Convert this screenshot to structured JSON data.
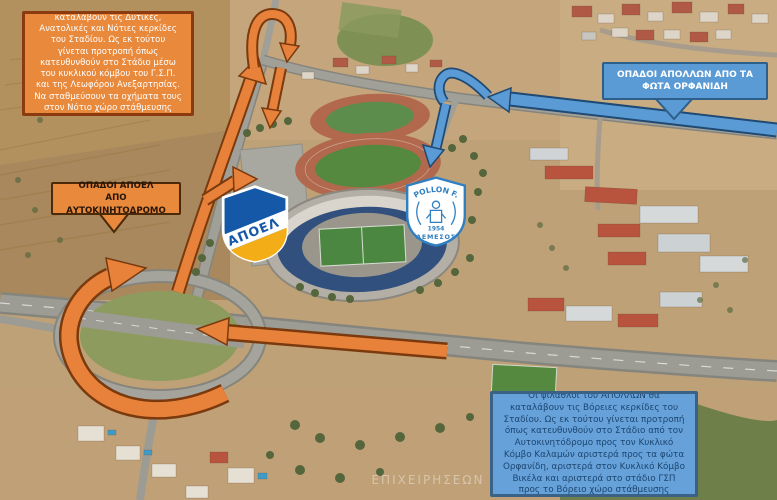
{
  "map": {
    "watermark": "ΕΠΙΧΕΙΡΗΣΕΩΝ",
    "colors": {
      "apoel_route_orange": "#e8823a",
      "apoel_route_outline": "#7a3a0e",
      "apollon_route_blue": "#5b9bd5",
      "apollon_route_outline": "#1f4a73",
      "orange_box_fill": "#e9893c",
      "orange_box_border": "#8c3a10",
      "blue_box_fill": "#5b9bd5",
      "blue_box_border": "#2e5f8a"
    }
  },
  "callouts": {
    "apoel_info": {
      "text": "Οι φίλαθλοι του ΑΠΟΕΛ θα καταλάβουν τις Δυτικές, Ανατολικές και Νότιες κερκίδες του Σταδίου. Ως εκ τούτου γίνεται προτροπή όπως κατευθυνθούν στο Στάδιο μέσω του κυκλικού κόμβου του Γ.Σ.Π. και της Λεωφόρου Ανεξαρτησίας. Να σταθμεύσουν τα οχήματα τους στον Νότιο χώρο στάθμευσης οχημάτων."
    },
    "apollon_from_lights": {
      "line1": "ΟΠΑΔΟΙ ΑΠΟΛΛΩΝ ΑΠΟ ΤΑ",
      "line2": "ΦΩΤΑ ΟΡΦΑΝΙΔΗ"
    },
    "apoel_from_highway": {
      "line1": "ΟΠΑΔΟΙ ΑΠΟΕΛ",
      "line2": "ΑΠΟ ΑΥΤΟΚΙΝΗΤΟΔΡΟΜΟ"
    },
    "apollon_info": {
      "text": "Οι φίλαθλοι του ΑΠΟΛΛΩΝ θα καταλάβουν τις Βόρειες κερκίδες του Σταδίου. Ως εκ τούτου γίνεται προτροπή όπως κατευθυνθούν στο Στάδιο από τον Αυτοκινητόδρομο προς τον Κυκλικό Κόμβο Καλαμών αριστερά προς τα φώτα Ορφανίδη, αριστερά στον Κυκλικό Κόμβο Βικέλα και αριστερά στο στάδιο ΓΣΠ προς το Βόρειο χώρο στάθμευσης"
    }
  },
  "logos": {
    "apoel": {
      "name": "ΑΠΟΕΛ"
    },
    "apollon": {
      "top": "APOLLON F.C",
      "year": "1954",
      "bottom": "ΛΕΜΕΣΟΣ"
    }
  }
}
